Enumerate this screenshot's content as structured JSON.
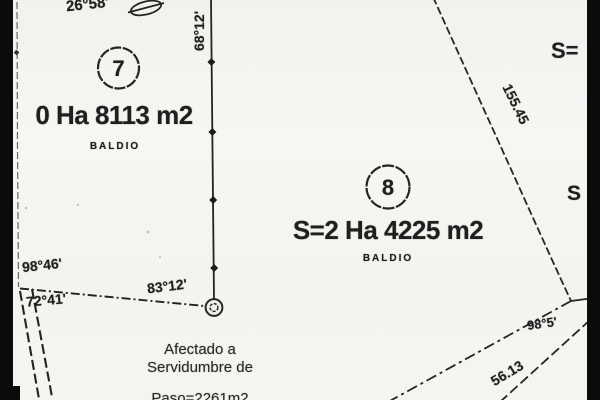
{
  "colors": {
    "paper": "#f5f4f1",
    "ink": "#1f1f1f",
    "scan_bar": "#0b0b0b"
  },
  "parcels": [
    {
      "number": "7",
      "area_label": "0 Ha 8113 m2",
      "status_label": "BALDIO"
    },
    {
      "number": "8",
      "area_label": "S=2 Ha 4225 m2",
      "status_label": "BALDIO"
    }
  ],
  "measurements": {
    "top_left_bearing": "26°58'",
    "north_line_bearing": "68°12'",
    "west_bearing_upper": "98°46'",
    "west_bearing_lower": "72°41'",
    "mid_bearing": "83°12'",
    "east_distance": "155.45",
    "southeast_bearing": "98°5'",
    "southeast_distance": "56.13"
  },
  "partial_labels": {
    "top_right": "S=",
    "mid_right": "S"
  },
  "easement_note": {
    "line1": "Afectado a",
    "line2": "Servidumbre de",
    "line3": "Paso=2261m2"
  }
}
